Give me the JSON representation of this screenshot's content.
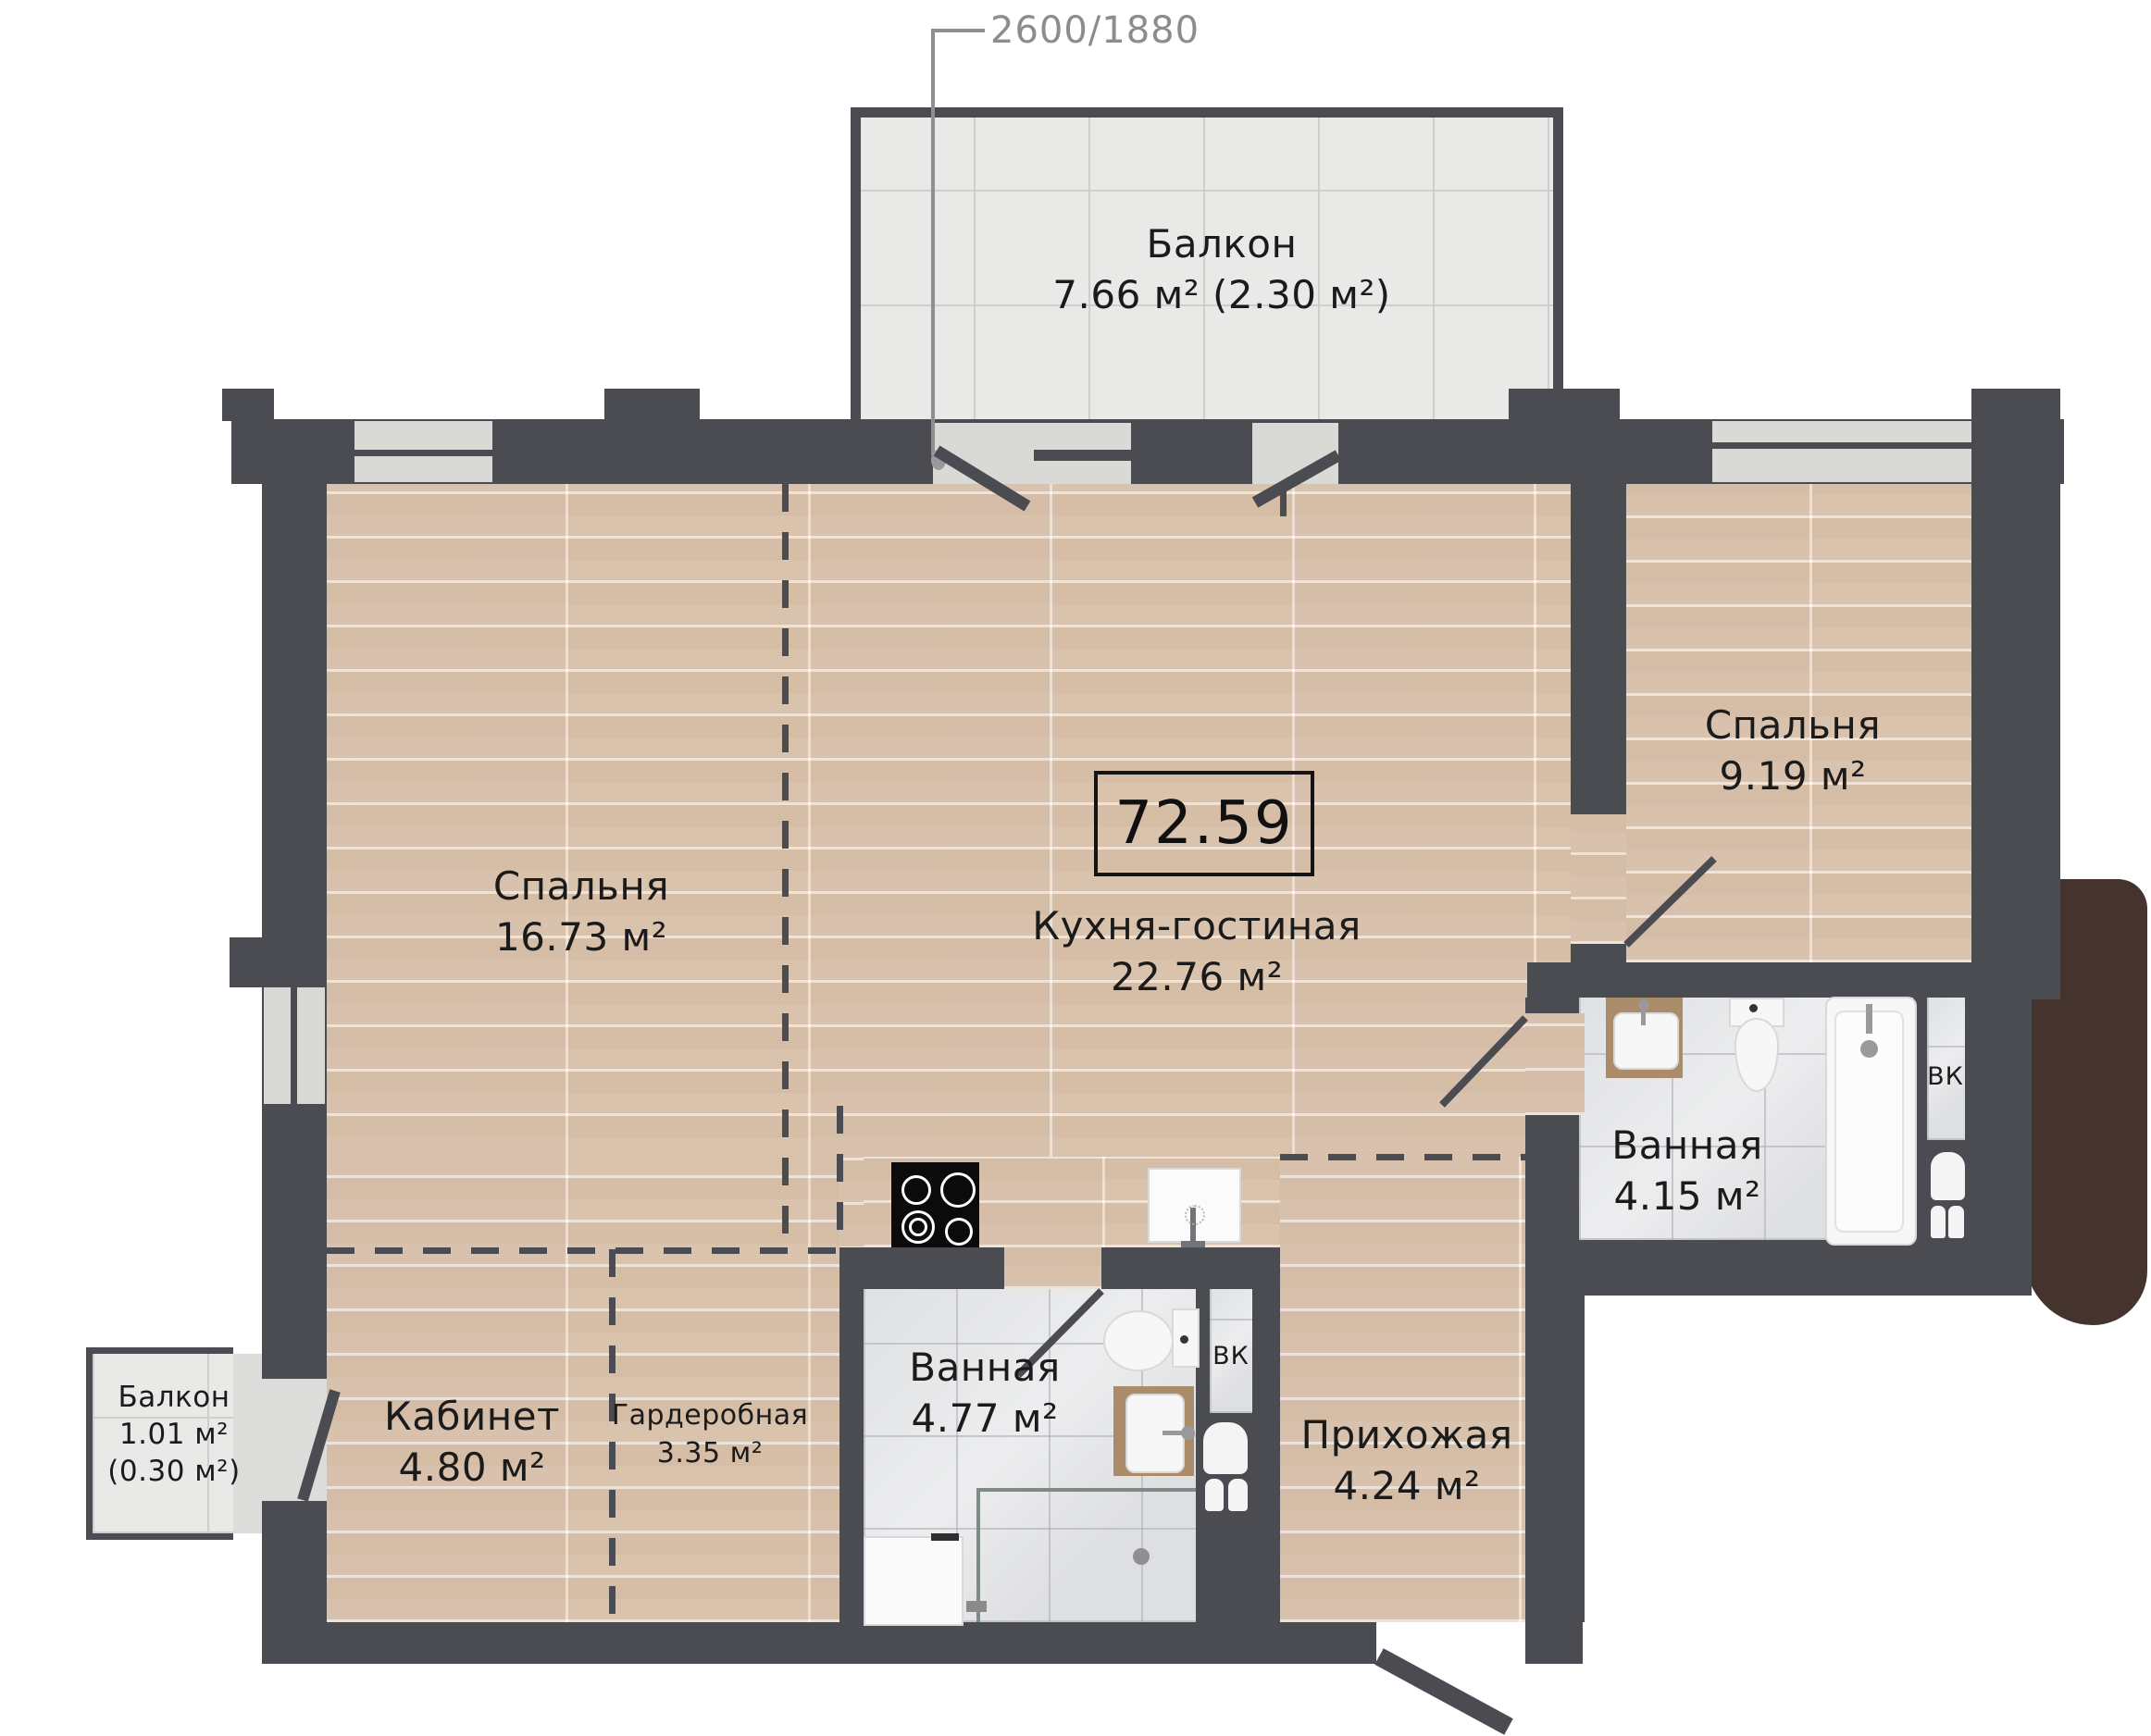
{
  "plan": {
    "dimension_label": "2600/1880",
    "total_area": "72.59",
    "shaft_label": "ВК",
    "rooms": {
      "bedroom_left": {
        "name": "Спальня",
        "area": "16.73 м²"
      },
      "kitchen_living": {
        "name": "Кухня-гостиная",
        "area": "22.76 м²"
      },
      "bedroom_right": {
        "name": "Спальня",
        "area": "9.19 м²"
      },
      "bathroom_right": {
        "name": "Ванная",
        "area": "4.15 м²"
      },
      "bathroom_lower": {
        "name": "Ванная",
        "area": "4.77 м²"
      },
      "office": {
        "name": "Кабинет",
        "area": "4.80 м²"
      },
      "wardrobe": {
        "name": "Гардеробная",
        "area": "3.35 м²"
      },
      "hallway": {
        "name": "Прихожая",
        "area": "4.24 м²"
      },
      "balcony_top": {
        "name": "Балкон",
        "area": "7.66 м² (2.30 м²)"
      },
      "balcony_small": {
        "name": "Балкон",
        "area_line1": "1.01 м²",
        "area_line2": "(0.30 м²)"
      }
    },
    "colors": {
      "wall": "#4b4b52",
      "wood_floor": "#e3cdb8",
      "tile_floor": "#ecedee",
      "balcony_tile": "#e9e9e7",
      "window_glass": "#d9d9d6",
      "accent_brown": "#44342d",
      "text": "#1b1b1b",
      "dimension_text": "#8c8c8c"
    }
  }
}
